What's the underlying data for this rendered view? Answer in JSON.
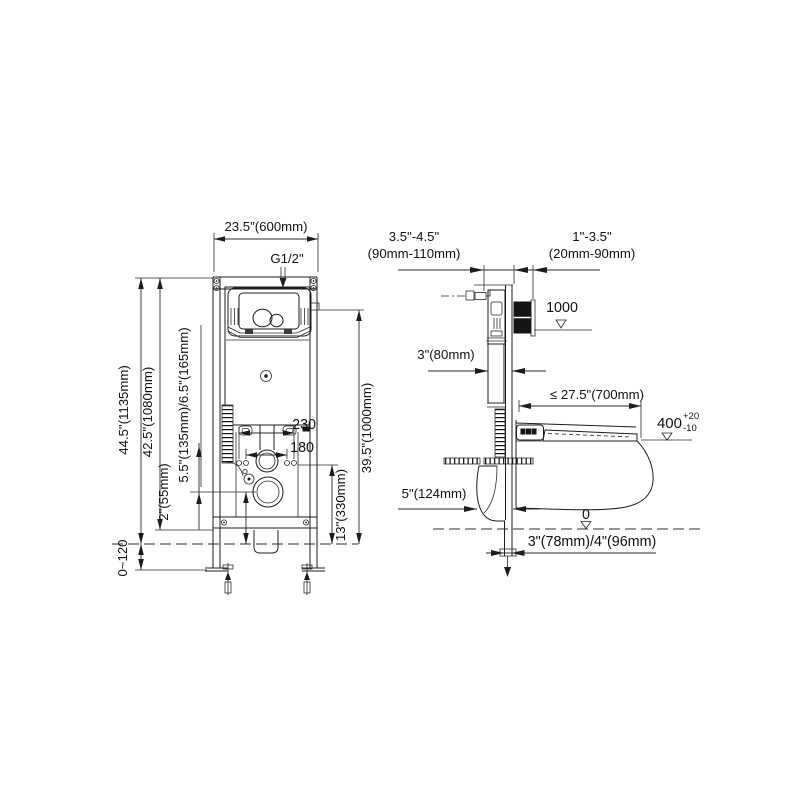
{
  "colors": {
    "line": "#1c1c1c",
    "background": "#ffffff",
    "flush_plate_side": "#141414"
  },
  "front_view": {
    "dim_width": "23.5\"(600mm)",
    "supply_thread": "G1/2\"",
    "dim_total_height": "44.5\"(1135mm)",
    "dim_frame_height": "42.5\"(1080mm)",
    "dim_outlet_center": "5.5\"(135mm)/6.5\"(165mm)",
    "dim_floor_gap": "2\"(55mm)",
    "dim_foot_adjust": "0~120",
    "dim_bolt_span_outer": "230",
    "dim_bolt_span_inner": "180",
    "dim_actuator_height": "39.5\"(1000mm)",
    "dim_fixing_height": "13\"(330mm)"
  },
  "side_view": {
    "dim_frame_depth_in": "3.5\"-4.5\"",
    "dim_frame_depth_mm": "(90mm-110mm)",
    "dim_wall_depth_in": "1\"-3.5\"",
    "dim_wall_depth_mm": "(20mm-90mm)",
    "datum_button_height": "1000",
    "dim_tank_depth": "3\"(80mm)",
    "dim_max_length": "≤ 27.5\"(700mm)",
    "datum_seat_height": "400",
    "datum_seat_tol_upper": "+20",
    "datum_seat_tol_lower": "-10",
    "dim_elbow": "5\"(124mm)",
    "datum_floor": "0",
    "dim_outlet_pipe": "3\"(78mm)/4\"(96mm)"
  }
}
